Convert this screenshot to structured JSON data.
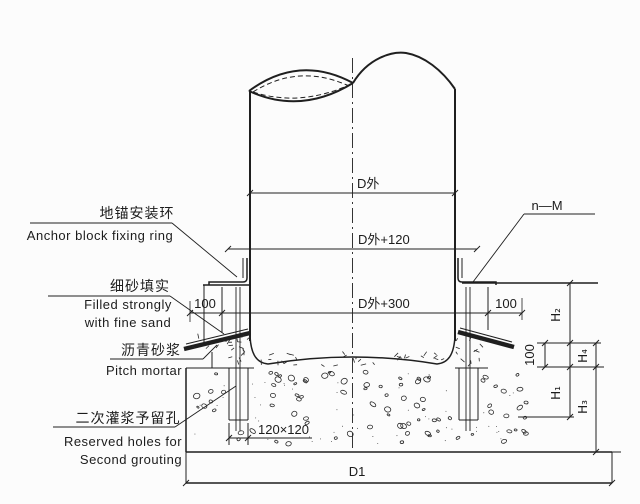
{
  "labels": {
    "anchor_ring_zh": "地锚安装环",
    "anchor_ring_en": "Anchor block fixing ring",
    "fine_sand_zh": "细砂填实",
    "fine_sand_en_1": "Filled strongly",
    "fine_sand_en_2": "with fine sand",
    "pitch_mortar_zh": "沥青砂浆",
    "pitch_mortar_en": "Pitch mortar",
    "grouting_zh": "二次灌浆予留孔",
    "grouting_en_1": "Reserved holes for",
    "grouting_en_2": "Second grouting",
    "bolt_spec": "n—M"
  },
  "dimensions": {
    "pipe_od": "D外",
    "pipe_od_plus_120": "D外+120",
    "pipe_od_plus_300": "D外+300",
    "base_width": "D1",
    "hole_size": "120×120",
    "gap_left": "100",
    "gap_right": "100",
    "mortar_step": "100",
    "h1": "H₁",
    "h2": "H₂",
    "h3": "H₃",
    "h4": "H₄"
  },
  "colors": {
    "line": "#1f1f1f",
    "background": "#fcfcfc"
  }
}
